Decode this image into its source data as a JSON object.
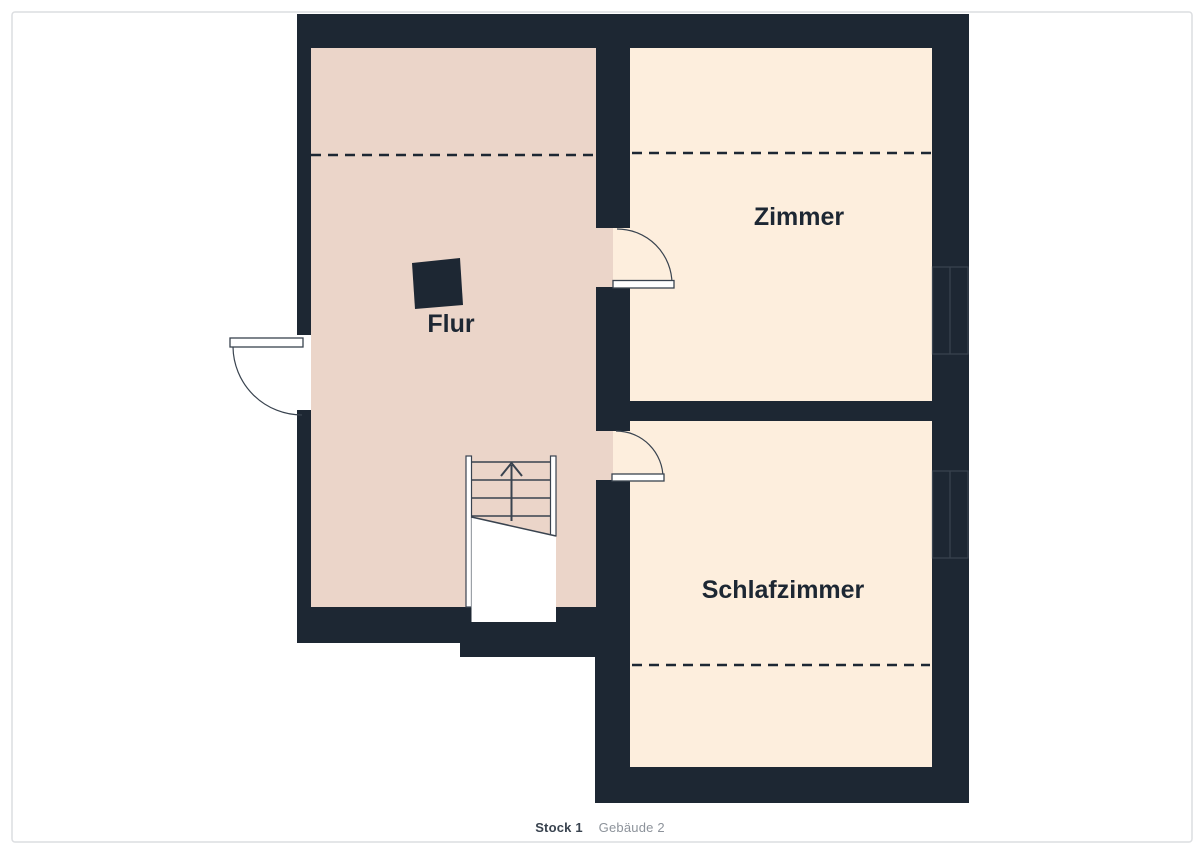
{
  "footer": {
    "floor_label": "Stock 1",
    "building_label": "Gebäude 2"
  },
  "rooms": [
    {
      "id": "flur",
      "label": "Flur"
    },
    {
      "id": "zimmer",
      "label": "Zimmer"
    },
    {
      "id": "schlafzimmer",
      "label": "Schlafzimmer"
    }
  ],
  "colors": {
    "background": "#ffffff",
    "frame_border": "#dcdee1",
    "wall": "#1d2733",
    "hallway_floor": "#ebd5c9",
    "room_floor": "#fdeedd",
    "detail_line": "#39434f",
    "label_text": "#1d2733",
    "footer_text": "#39434f",
    "footer_muted": "#8d939b"
  }
}
